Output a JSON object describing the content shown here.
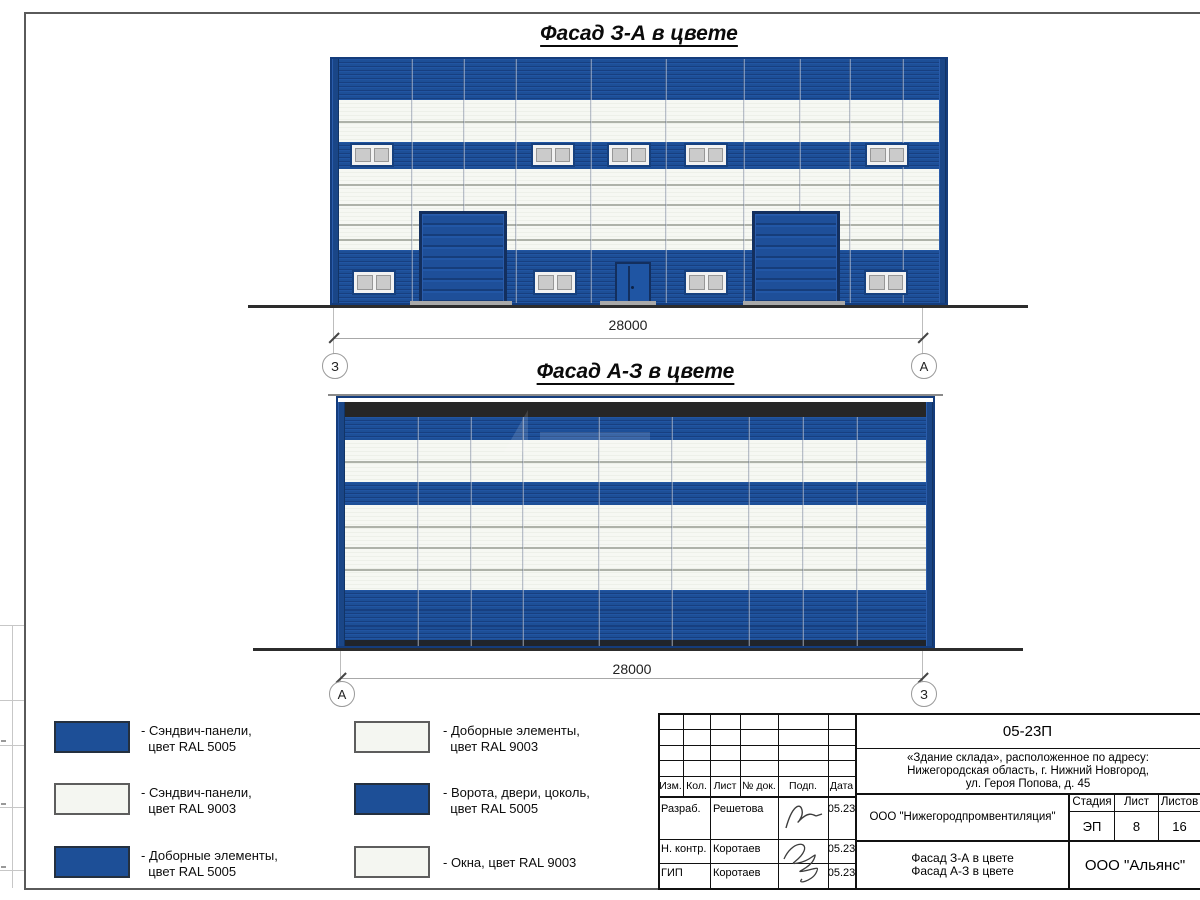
{
  "facade1": {
    "title": "Фасад З-А в цвете",
    "dimension": "28000",
    "axis_left": "З",
    "axis_right": "А"
  },
  "facade2": {
    "title": "Фасад А-З в цвете",
    "dimension": "28000",
    "axis_left": "А",
    "axis_right": "З"
  },
  "legend": {
    "items": [
      {
        "color_name": "RAL 5005 blue",
        "swatch": "#1d4f97",
        "line1": "- Сэндвич-панели,",
        "line2": "  цвет RAL 5005"
      },
      {
        "color_name": "RAL 9003 white",
        "swatch": "#f4f6f1",
        "line1": "- Сэндвич-панели,",
        "line2": "  цвет RAL 9003"
      },
      {
        "color_name": "RAL 5005 blue",
        "swatch": "#1d4f97",
        "line1": "- Доборные элементы,",
        "line2": "  цвет RAL 5005"
      },
      {
        "color_name": "RAL 9003 white",
        "swatch": "#f4f6f1",
        "line1": "- Доборные элементы,",
        "line2": "  цвет RAL 9003"
      },
      {
        "color_name": "RAL 5005 blue",
        "swatch": "#1d4f97",
        "line1": "- Ворота, двери, цоколь,",
        "line2": "  цвет RAL 5005"
      },
      {
        "color_name": "RAL 9003 white",
        "swatch": "#f4f6f1",
        "line1": "- Окна, цвет RAL 9003",
        "line2": ""
      }
    ]
  },
  "title_block": {
    "doc_number": "05-23П",
    "address_line1": "«Здание склада», расположенное по адресу:",
    "address_line2": "Нижегородская область, г. Нижний Новгород,",
    "address_line3": "ул. Героя Попова, д. 45",
    "organization": "ООО \"Нижегородпромвентиляция\"",
    "stage_label": "Стадия",
    "sheet_label": "Лист",
    "sheets_label": "Листов",
    "stage": "ЭП",
    "sheet": "8",
    "sheets": "16",
    "content_line1": "Фасад З-А в цвете",
    "content_line2": "Фасад А-З в цвете",
    "company": "ООО \"Альянс\"",
    "header": {
      "izm": "Изм.",
      "kol": "Кол.",
      "list": "Лист",
      "doc": "№ док.",
      "podp": "Подп.",
      "data": "Дата"
    },
    "rows": [
      {
        "role": "Разраб.",
        "name": "Решетова",
        "date": "05.23"
      },
      {
        "role": "Н. контр.",
        "name": "Коротаев",
        "date": "05.23"
      },
      {
        "role": "ГИП",
        "name": "Коротаев",
        "date": "05.23"
      }
    ]
  },
  "colors": {
    "ral5005": "#1d4f97",
    "ral9003": "#f4f6f1",
    "frame_dark": "#143c7c",
    "parapet": "#262626"
  }
}
